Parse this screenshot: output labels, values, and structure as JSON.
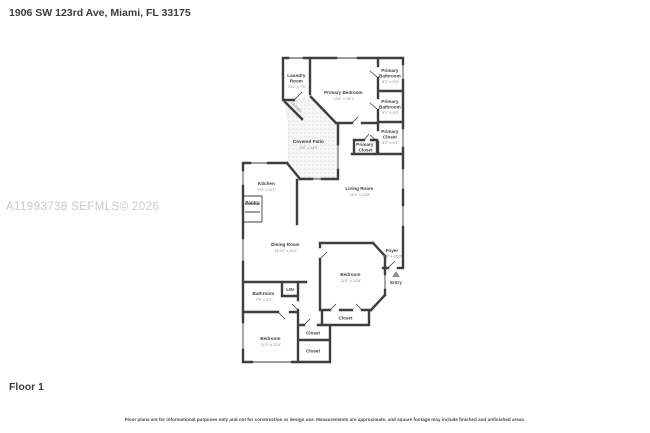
{
  "page": {
    "title": "1906 SW 123rd Ave, Miami, FL 33175",
    "watermark": "A11993738  SEFMLS© 2026",
    "floor_label": "Floor 1",
    "disclaimer": "Floor plans are for informational purposes only and not for construction or design use. Measurements are approximate, and square footage may include finished and unfinished areas."
  },
  "colors": {
    "wall": "#3e3e3e",
    "room_name_text": "#3f3f3f",
    "dimension_text": "#8c8c8c",
    "watermark_text": "#c9c9c9",
    "entry_arrow": "#8f8f8f"
  },
  "rooms": {
    "laundry": {
      "line1": "Laundry",
      "line2": "Room",
      "dims": "3'11\" x 7'0\""
    },
    "primary_bedroom": {
      "name": "Primary Bedroom",
      "dims": "13'0\" x 15'1\""
    },
    "primary_bathroom_1": {
      "line1": "Primary",
      "line2": "Bathroom",
      "dims": "5'2\" x 5'6\""
    },
    "primary_bathroom_2": {
      "line1": "Primary",
      "line2": "Bathroom",
      "dims": "5'2\" x 6'9\""
    },
    "primary_closet_right": {
      "line1": "Primary",
      "line2": "Closet",
      "dims": "5'2\" x 5'1\""
    },
    "primary_closet_small": {
      "line1": "Primary",
      "line2": "Closet"
    },
    "covered_patio": {
      "name": "Covered Patio",
      "dims": "9'6\" x 14'9\""
    },
    "storage": {
      "name": "Storage"
    },
    "kitchen": {
      "name": "Kitchen",
      "dims": "9'9\" x 11'0\""
    },
    "pantry": {
      "name": "Pantry"
    },
    "living_room": {
      "name": "Living Room",
      "dims": "21'1\" x 13'8\""
    },
    "dining_room": {
      "name": "Dining Room",
      "dims": "14'10\" x 10'1\""
    },
    "foyer": {
      "name": "Foyer",
      "dims": "6'5\" x 4'10\""
    },
    "entry": {
      "name": "Entry"
    },
    "bedroom_right": {
      "name": "Bedroom",
      "dims": "11'6\" x 13'8\""
    },
    "bathroom": {
      "name": "Bathroom",
      "dims": "7'9\" x 5'2\""
    },
    "linen_closet": {
      "name": "LIN"
    },
    "bedroom_left": {
      "name": "Bedroom",
      "dims": "11'0\" x 11'6\""
    },
    "closet_bedroom_right": {
      "name": "Closet"
    },
    "closet_hall_upper": {
      "name": "Closet"
    },
    "closet_hall_lower": {
      "name": "Closet"
    }
  }
}
